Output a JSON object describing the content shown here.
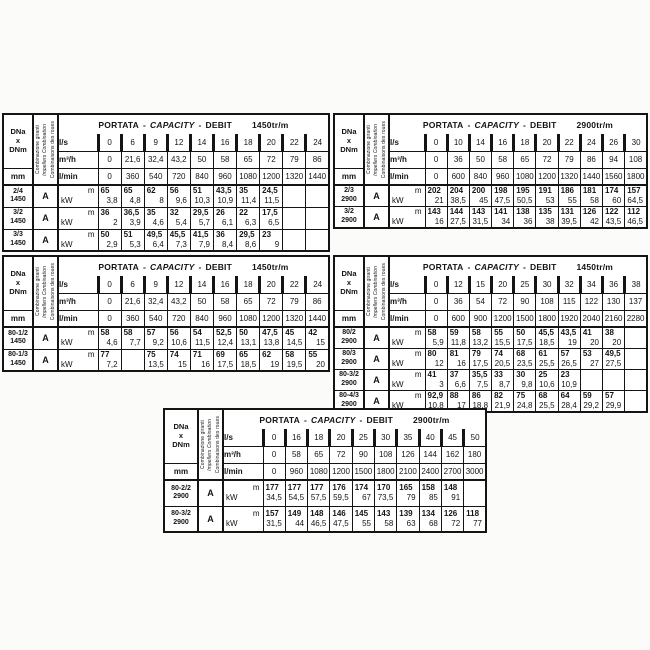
{
  "shared": {
    "title_portata": "PORTATA",
    "title_capacity": "CAPACITY",
    "title_debit": "DEBIT",
    "dash": "-",
    "corner_dna": "DNa",
    "corner_x": "x",
    "corner_dnm": "DNm",
    "mm": "mm",
    "combo_labels": [
      "Combinazione giranti",
      "Impellers Combination",
      "Combinaisons des roues"
    ],
    "unit_ls": "l/s",
    "unit_m3h": "m³/h",
    "unit_lmin": "l/min",
    "unit_m": "m",
    "unit_kw": "kW"
  },
  "tables": [
    {
      "key": "top-left-1450",
      "speed": "1450tr/m",
      "ls": [
        "0",
        "6",
        "9",
        "12",
        "14",
        "16",
        "18",
        "20",
        "22",
        "24"
      ],
      "m3h": [
        "0",
        "21,6",
        "32,4",
        "43,2",
        "50",
        "58",
        "65",
        "72",
        "79",
        "86"
      ],
      "lmin": [
        "0",
        "360",
        "540",
        "720",
        "840",
        "960",
        "1080",
        "1200",
        "1320",
        "1440"
      ],
      "rows": [
        {
          "model": "2/4",
          "sub": "1450",
          "combo": "A",
          "m": [
            "65",
            "65",
            "62",
            "56",
            "51",
            "43,5",
            "35",
            "24,5",
            "",
            ""
          ],
          "kw": [
            "3,8",
            "4,8",
            "8",
            "9,6",
            "10,3",
            "10,9",
            "11,4",
            "11,5",
            "",
            ""
          ]
        },
        {
          "model": "3/2",
          "sub": "1450",
          "combo": "A",
          "m": [
            "36",
            "36,5",
            "35",
            "32",
            "29,5",
            "26",
            "22",
            "17,5",
            "",
            ""
          ],
          "kw": [
            "2",
            "3,9",
            "4,6",
            "5,4",
            "5,7",
            "6,1",
            "6,3",
            "6,5",
            "",
            ""
          ]
        },
        {
          "model": "3/3",
          "sub": "1450",
          "combo": "A",
          "m": [
            "50",
            "51",
            "49,5",
            "45,5",
            "41,5",
            "36",
            "29,5",
            "23",
            "",
            ""
          ],
          "kw": [
            "2,9",
            "5,3",
            "6,4",
            "7,3",
            "7,9",
            "8,4",
            "8,6",
            "9",
            "",
            ""
          ]
        }
      ]
    },
    {
      "key": "top-right-2900",
      "speed": "2900tr/m",
      "ls": [
        "0",
        "10",
        "14",
        "16",
        "18",
        "20",
        "22",
        "24",
        "26",
        "30"
      ],
      "m3h": [
        "0",
        "36",
        "50",
        "58",
        "65",
        "72",
        "79",
        "86",
        "94",
        "108"
      ],
      "lmin": [
        "0",
        "600",
        "840",
        "960",
        "1080",
        "1200",
        "1320",
        "1440",
        "1560",
        "1800"
      ],
      "rows": [
        {
          "model": "2/3",
          "sub": "2900",
          "combo": "A",
          "m": [
            "202",
            "204",
            "200",
            "198",
            "195",
            "191",
            "186",
            "181",
            "174",
            "157"
          ],
          "kw": [
            "21",
            "38,5",
            "45",
            "47,5",
            "50,5",
            "53",
            "55",
            "58",
            "60",
            "64,5"
          ]
        },
        {
          "model": "3/2",
          "sub": "2900",
          "combo": "A",
          "m": [
            "143",
            "144",
            "143",
            "141",
            "138",
            "135",
            "131",
            "126",
            "122",
            "112"
          ],
          "kw": [
            "16",
            "27,5",
            "31,5",
            "34",
            "36",
            "38",
            "39,5",
            "42",
            "43,5",
            "46,5"
          ]
        }
      ]
    },
    {
      "key": "mid-left-1450",
      "speed": "1450tr/m",
      "ls": [
        "0",
        "6",
        "9",
        "12",
        "14",
        "16",
        "18",
        "20",
        "22",
        "24"
      ],
      "m3h": [
        "0",
        "21,6",
        "32,4",
        "43,2",
        "50",
        "58",
        "65",
        "72",
        "79",
        "86"
      ],
      "lmin": [
        "0",
        "360",
        "540",
        "720",
        "840",
        "960",
        "1080",
        "1200",
        "1320",
        "1440"
      ],
      "rows": [
        {
          "model": "80-1/2",
          "sub": "1450",
          "combo": "A",
          "m": [
            "58",
            "58",
            "57",
            "56",
            "54",
            "52,5",
            "50",
            "47,5",
            "45",
            "42"
          ],
          "kw": [
            "4,6",
            "7,7",
            "9,2",
            "10,6",
            "11,5",
            "12,4",
            "13,1",
            "13,8",
            "14,5",
            "15"
          ]
        },
        {
          "model": "80-1/3",
          "sub": "1450",
          "combo": "A",
          "m": [
            "77",
            "",
            "75",
            "74",
            "71",
            "69",
            "65",
            "62",
            "58",
            "55"
          ],
          "kw": [
            "7,2",
            "",
            "13,5",
            "15",
            "16",
            "17,5",
            "18,5",
            "19",
            "19,5",
            "20"
          ]
        }
      ]
    },
    {
      "key": "mid-right-1450",
      "speed": "1450tr/m",
      "ls": [
        "0",
        "12",
        "15",
        "20",
        "25",
        "30",
        "32",
        "34",
        "36",
        "38"
      ],
      "m3h": [
        "0",
        "36",
        "54",
        "72",
        "90",
        "108",
        "115",
        "122",
        "130",
        "137"
      ],
      "lmin": [
        "0",
        "600",
        "900",
        "1200",
        "1500",
        "1800",
        "1920",
        "2040",
        "2160",
        "2280"
      ],
      "rows": [
        {
          "model": "80/2",
          "sub": "2900",
          "combo": "A",
          "m": [
            "58",
            "59",
            "58",
            "55",
            "50",
            "45,5",
            "43,5",
            "41",
            "38",
            ""
          ],
          "kw": [
            "5,9",
            "11,8",
            "13,2",
            "15,5",
            "17,5",
            "18,5",
            "19",
            "20",
            "20",
            ""
          ]
        },
        {
          "model": "80/3",
          "sub": "2900",
          "combo": "A",
          "m": [
            "80",
            "81",
            "79",
            "74",
            "68",
            "61",
            "57",
            "53",
            "49,5",
            ""
          ],
          "kw": [
            "12",
            "16",
            "17,5",
            "20,5",
            "23,5",
            "25,5",
            "26,5",
            "27",
            "27,5",
            ""
          ]
        },
        {
          "model": "80-3/2",
          "sub": "2900",
          "combo": "A",
          "m": [
            "41",
            "37",
            "35,5",
            "33",
            "30",
            "25",
            "23",
            "",
            "",
            ""
          ],
          "kw": [
            "3",
            "6,6",
            "7,5",
            "8,7",
            "9,8",
            "10,6",
            "10,9",
            "",
            "",
            ""
          ]
        },
        {
          "model": "80-4/3",
          "sub": "2900",
          "combo": "A",
          "m": [
            "92,9",
            "88",
            "86",
            "82",
            "75",
            "68",
            "64",
            "59",
            "57",
            ""
          ],
          "kw": [
            "10,8",
            "17",
            "18,8",
            "21,9",
            "24,8",
            "25,5",
            "28,4",
            "29,2",
            "29,9",
            ""
          ]
        }
      ]
    },
    {
      "key": "bottom-2900",
      "speed": "2900tr/m",
      "ls": [
        "0",
        "16",
        "18",
        "20",
        "25",
        "30",
        "35",
        "40",
        "45",
        "50"
      ],
      "m3h": [
        "0",
        "58",
        "65",
        "72",
        "90",
        "108",
        "126",
        "144",
        "162",
        "180"
      ],
      "lmin": [
        "0",
        "960",
        "1080",
        "1200",
        "1500",
        "1800",
        "2100",
        "2400",
        "2700",
        "3000"
      ],
      "rows": [
        {
          "model": "80-2/2",
          "sub": "2900",
          "combo": "A",
          "m": [
            "177",
            "177",
            "177",
            "176",
            "174",
            "170",
            "165",
            "158",
            "148",
            ""
          ],
          "kw": [
            "34,5",
            "54,5",
            "57,5",
            "59,5",
            "67",
            "73,5",
            "79",
            "85",
            "91",
            ""
          ]
        },
        {
          "model": "80-3/2",
          "sub": "2900",
          "combo": "A",
          "m": [
            "157",
            "149",
            "148",
            "146",
            "145",
            "143",
            "139",
            "134",
            "126",
            "118"
          ],
          "kw": [
            "31,5",
            "44",
            "46,5",
            "47,5",
            "55",
            "58",
            "63",
            "68",
            "72",
            "77"
          ]
        }
      ]
    }
  ]
}
